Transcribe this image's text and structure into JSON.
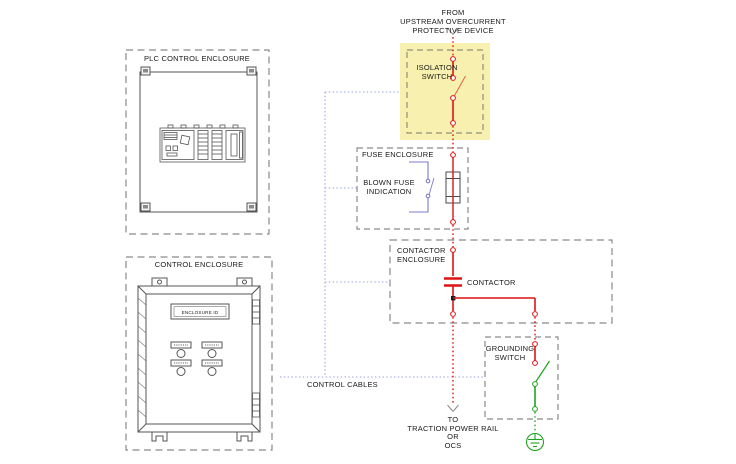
{
  "colors": {
    "power_red": "#de1414",
    "switch_blade_red": "#e4553c",
    "ground_green": "#1ea31e",
    "control_cable_blue": "#9aa0e0",
    "indication_blue": "#7b7bd0",
    "enclosure_dash_gray": "#8a8a8a",
    "drawing_gray": "#555555",
    "highlight_yellow": "#f7f0ae",
    "background": "#ffffff"
  },
  "source": {
    "lines": [
      "FROM",
      "UPSTREAM OVERCURRENT",
      "PROTECTIVE DEVICE"
    ]
  },
  "plc_enclosure": {
    "title": "PLC CONTROL ENCLOSURE"
  },
  "control_enclosure": {
    "title": "CONTROL ENCLOSURE",
    "id_plate": "ENCLOSURE ID"
  },
  "isolation_switch": {
    "lines": [
      "ISOLATION",
      "SWITCH"
    ]
  },
  "fuse_enclosure": {
    "title": "FUSE ENCLOSURE"
  },
  "blown_fuse": {
    "lines": [
      "BLOWN FUSE",
      "INDICATION"
    ]
  },
  "contactor_enclosure": {
    "title_lines": [
      "CONTACTOR",
      "ENCLOSURE"
    ],
    "contactor_label": "CONTACTOR"
  },
  "grounding_switch": {
    "lines": [
      "GROUNDING",
      "SWITCH"
    ]
  },
  "control_cables_label": "CONTROL CABLES",
  "destination": {
    "lines": [
      "TO",
      "TRACTION POWER RAIL",
      "OR",
      "OCS"
    ]
  }
}
